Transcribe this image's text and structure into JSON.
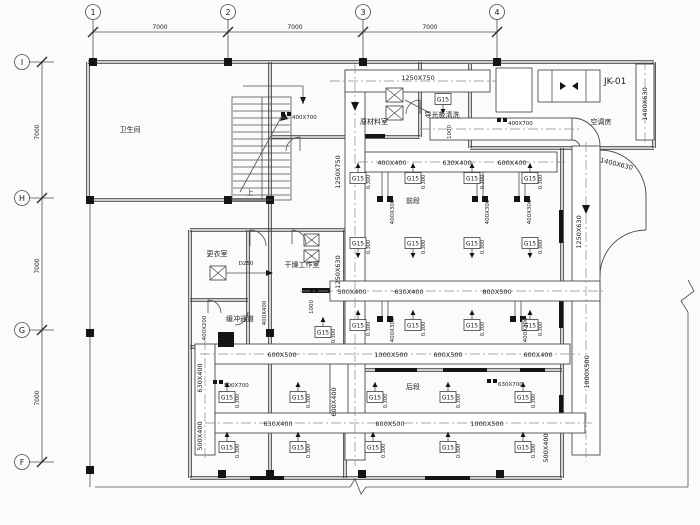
{
  "grid": {
    "top_bubbles": [
      "1",
      "2",
      "3",
      "4"
    ],
    "left_bubbles": [
      "I",
      "H",
      "G",
      "F"
    ],
    "span": "7000"
  },
  "rooms": {
    "washroom": "卫生间",
    "raw_material": "原材料室",
    "cleaner": "导光板清洗",
    "ac_room": "空调房",
    "ahu_tag": "JK-01",
    "changing": "更衣室",
    "drying": "干燥工作室",
    "buffer": "缓冲通道",
    "front": "前段",
    "rear": "后段",
    "stair_up": "上"
  },
  "diffuser": {
    "tag": "G15",
    "flow": "0.300"
  },
  "duct_labels": {
    "main_top": "1250X750",
    "main_left_upper": "1250X750",
    "main_left_lower": "1250X630",
    "right_trunk_upper": "1250X630",
    "right_trunk_lower": "1000X500",
    "elbow_right": "1400X630",
    "intake": "1400X630",
    "rowA": [
      "400X400",
      "630X400",
      "600X400"
    ],
    "rowB": [
      "500X400",
      "630X400",
      "800X500"
    ],
    "rowC": [
      "600X500",
      "1000X500",
      "600X500",
      "600X400"
    ],
    "rowD_left": "630X400",
    "rowD": [
      "800X500",
      "1000X500"
    ],
    "riser": "400X300",
    "left_drop_upper": "630X400",
    "left_drop_lower": "500X400",
    "mid_drop": "600X400",
    "right_riser": "500X400",
    "drop_a": "1000",
    "buffer_drop": "1000",
    "exhaust": "D250",
    "buffer_v1": "400X200",
    "buffer_v2": "400X400"
  },
  "dampers": {
    "fd_stair": "400X700",
    "fd_ahu": "400X700",
    "fd_rear_left": "500X700",
    "fd_rear_right": "630X700"
  }
}
